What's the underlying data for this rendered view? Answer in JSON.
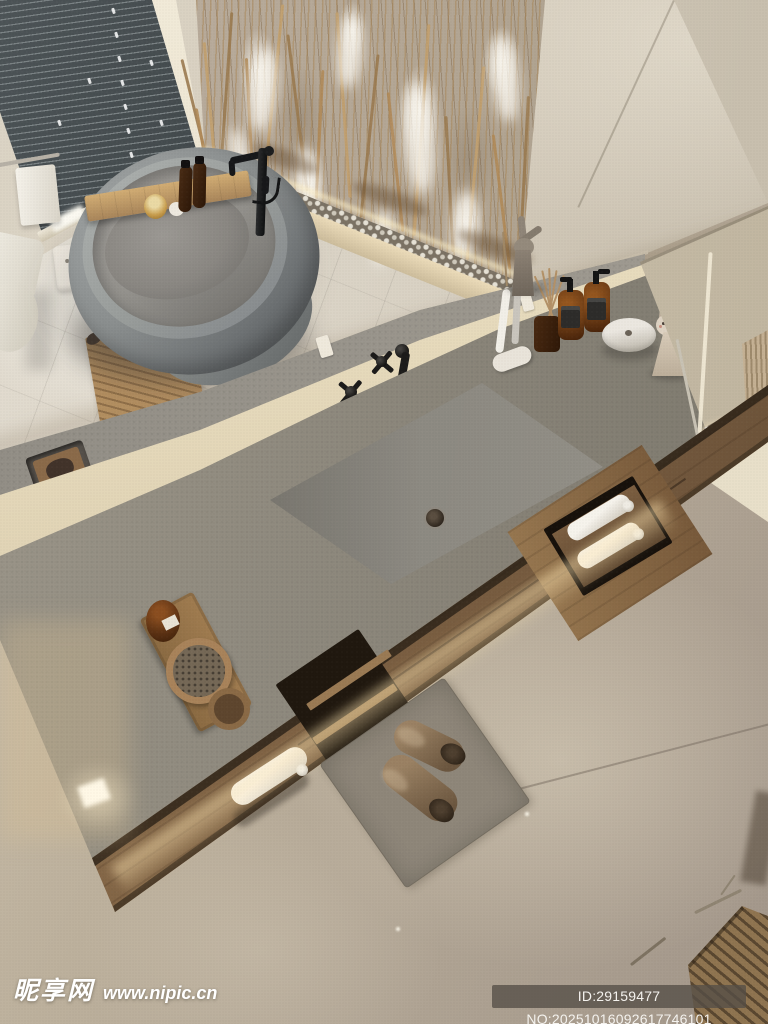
{
  "page": {
    "type": "stock-photo-preview",
    "title": "Minimalist bathroom interior, top-down 3D render"
  },
  "scene": {
    "description": "Top-down view of a warm minimalist bathroom: freestanding grey bathtub with wooden caddy, long grey stone vanity with integrated sink and black wall-mounted taps, wooden cabinet with rolled towels, dried pampas grass against a backlit stone feature wall, venetian blinds, grey rug with fluffy slippers on a beige floor",
    "objects": [
      {
        "name": "venetian-blinds",
        "label": "dark venetian blinds window",
        "color": "#343b3d"
      },
      {
        "name": "stone-feature-wall",
        "label": "backlit travertine feature wall",
        "color": "#b0a291"
      },
      {
        "name": "pampas-grass",
        "label": "dried pampas grass and reeds",
        "color": "#b99463"
      },
      {
        "name": "pebble-trough",
        "label": "white pebble trough with LED strip",
        "color": "#e6e1d5"
      },
      {
        "name": "bathtub",
        "label": "freestanding grey soaking tub",
        "color": "#8b8f8f"
      },
      {
        "name": "bath-caddy",
        "label": "wooden bath caddy tray with bottles and candle",
        "color": "#c9a76b"
      },
      {
        "name": "floor-faucet",
        "label": "black freestanding tub filler",
        "color": "#17181a"
      },
      {
        "name": "bath-mat",
        "label": "wooden slatted bath mat",
        "color": "#a5825a"
      },
      {
        "name": "toilet",
        "label": "white toilet (partial)",
        "color": "#ece8dd"
      },
      {
        "name": "wall-outlet",
        "label": "white wall outlet",
        "color": "#f0ebe1"
      },
      {
        "name": "vanity-counter",
        "label": "long grey stone vanity counter",
        "color": "#8e897d"
      },
      {
        "name": "integrated-sink",
        "label": "integrated rectangular sink with drain",
        "color": "#8d8a82"
      },
      {
        "name": "wall-faucet",
        "label": "black cross-handle wall taps and spout",
        "color": "#1c1b1a"
      },
      {
        "name": "soap-recess",
        "label": "recessed soap tray in ledge",
        "color": "#8a6a49"
      },
      {
        "name": "vanity-tray",
        "label": "wooden tray with amber jar and round brush",
        "color": "#a07c50"
      },
      {
        "name": "toothbrushes",
        "label": "electric toothbrushes on stand",
        "color": "#f2efe8"
      },
      {
        "name": "reed-diffuser",
        "label": "amber reed diffuser",
        "color": "#4a2a12"
      },
      {
        "name": "soap-dispensers",
        "label": "two amber soap dispenser bottles",
        "color": "#6b3b15"
      },
      {
        "name": "ceramic-box",
        "label": "round white ceramic box",
        "color": "#ebe7e0"
      },
      {
        "name": "bunny-figurine",
        "label": "bunny-ear girl figurine",
        "color": "#d8cbb8"
      },
      {
        "name": "rabbit-sculpture",
        "label": "rabbit sculpture on ledge",
        "color": "#8d8275"
      },
      {
        "name": "wooden-cabinet",
        "label": "floating wooden vanity cabinet",
        "color": "#8d6e4c"
      },
      {
        "name": "towel-rolls",
        "label": "rolled white towels in open shelf",
        "color": "#f6f3ec"
      },
      {
        "name": "area-rug",
        "label": "grey area rug",
        "color": "#8e8679"
      },
      {
        "name": "slippers",
        "label": "brown fluffy slippers",
        "color": "#7d6a52"
      },
      {
        "name": "wooden-stool",
        "label": "wooden slatted stool with twigs",
        "color": "#8f7450"
      },
      {
        "name": "beige-floor",
        "label": "warm beige microcement floor",
        "color": "#bcb09c"
      }
    ]
  },
  "palette": {
    "wall": "#d6cdbd",
    "floor": "#bcb09c",
    "counter": "#8e897d",
    "backsplash_light": "#eee3c5",
    "wood": "#8d6e4c",
    "accent_glow": "#ffe9c0",
    "fixture_black": "#17181a"
  },
  "watermark": {
    "site_name": "昵享网",
    "site_url": "www.nipic.cn",
    "image_id": "ID:29159477 NO:20251016092617746101"
  }
}
